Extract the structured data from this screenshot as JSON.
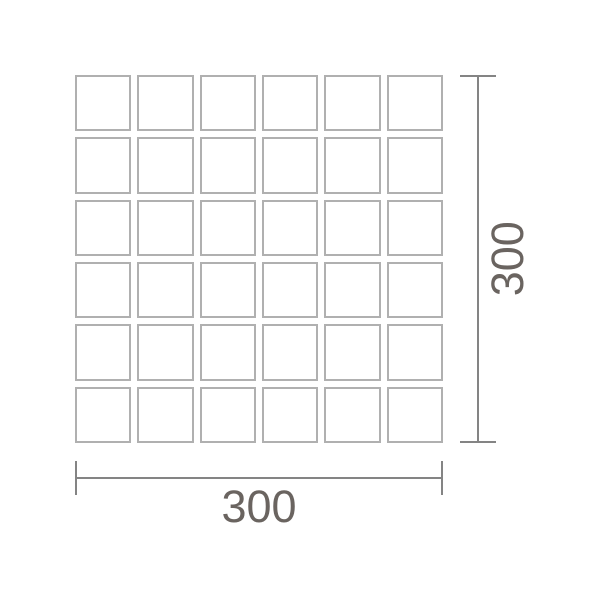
{
  "diagram": {
    "grid": {
      "rows": 6,
      "columns": 6
    },
    "dimensions": {
      "width_label": "300",
      "height_label": "300"
    },
    "colors": {
      "background": "#ffffff",
      "tile_fill": "#ffffff",
      "tile_border": "#b0b0b0",
      "dimension_line": "#848484",
      "label_text": "#6a6460"
    }
  }
}
